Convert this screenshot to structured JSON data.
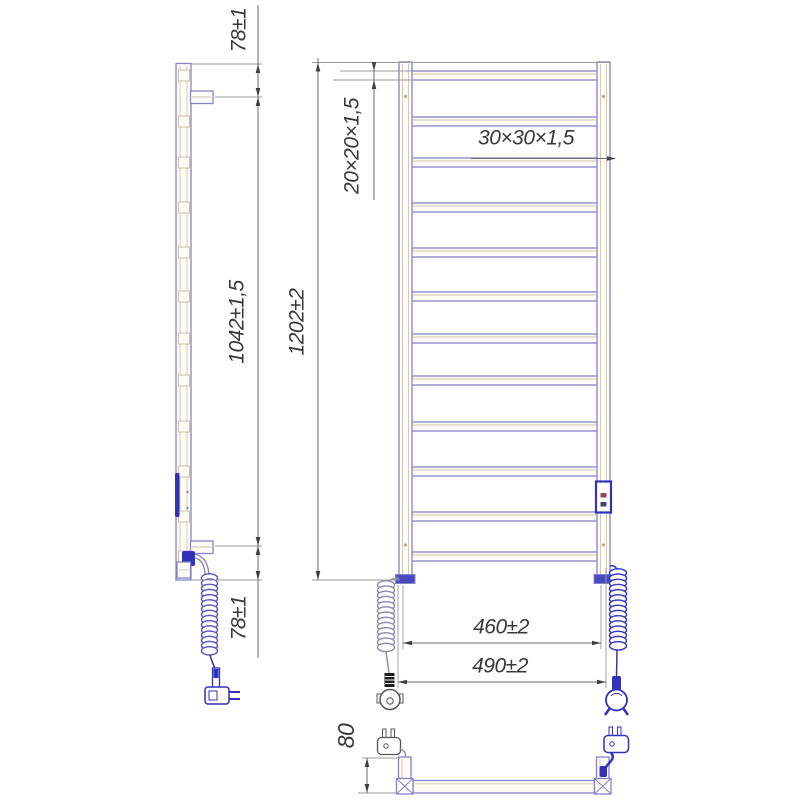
{
  "page": {
    "background": "#ffffff"
  },
  "colors": {
    "frame_outline": "#8483c5",
    "tube_shading": "#cfc5a8",
    "electric_blue": "#3231bb",
    "cable_gray": "#8e90ad",
    "dimension_lines": "#6e6e6e",
    "dimension_text": "#383838"
  },
  "dimensions": {
    "side_top_offset": "78±1",
    "side_bracket_span": "1042±1,5",
    "overall_height": "1202±2",
    "rung_tube_section": "20×20×1,5",
    "post_tube_section": "30×30×1,5",
    "rail_width_centers": "460±2",
    "overall_width": "490±2",
    "side_bottom_offset": "78±1",
    "wall_depth": "80"
  }
}
